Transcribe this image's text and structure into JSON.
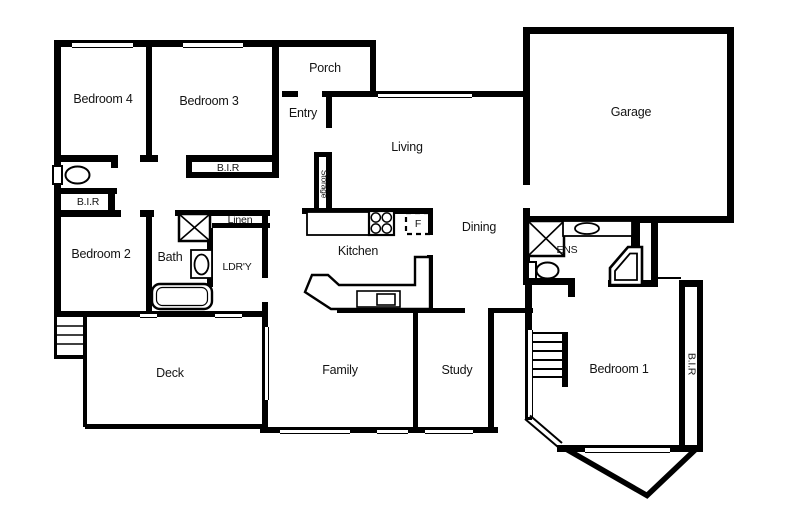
{
  "figure": "residential floor plan",
  "colors": {
    "wall": "#000000",
    "background": "#ffffff",
    "text": "#141414"
  },
  "rooms": {
    "bedroom4": "Bedroom 4",
    "bedroom3": "Bedroom 3",
    "porch": "Porch",
    "entry": "Entry",
    "living": "Living",
    "garage": "Garage",
    "bir_bedroom3": "B.I.R",
    "bir_hall": "B.I.R",
    "bedroom2": "Bedroom 2",
    "bath": "Bath",
    "linen": "Linen",
    "laundry": "LDR'Y",
    "storage": "Storage",
    "kitchen": "Kitchen",
    "dining": "Dining",
    "ens": "ENS",
    "fridge": "F",
    "deck": "Deck",
    "family": "Family",
    "study": "Study",
    "bedroom1": "Bedroom 1",
    "bir_bedroom1": "B.I.R"
  }
}
